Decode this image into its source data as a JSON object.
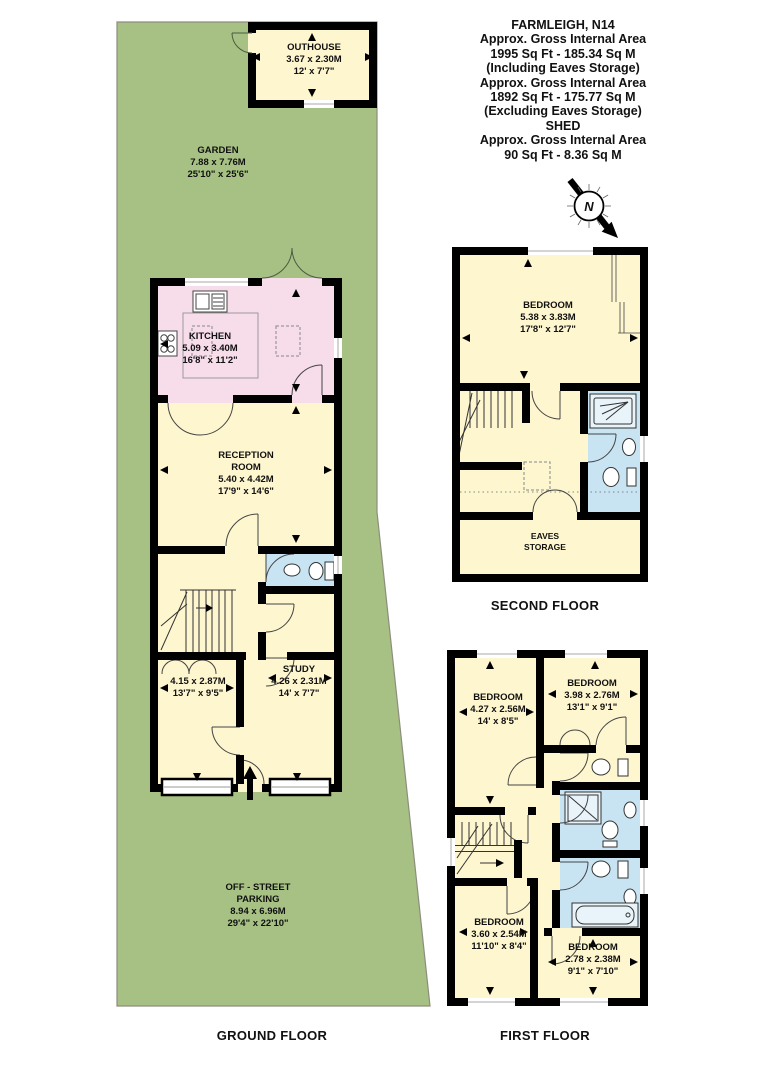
{
  "header": {
    "lines": [
      "FARMLEIGH, N14",
      "Approx. Gross Internal Area",
      "1995 Sq Ft - 185.34 Sq M",
      "(Including Eaves Storage)",
      "Approx. Gross Internal Area",
      "1892 Sq Ft - 175.77 Sq M",
      "(Excluding Eaves Storage)",
      "SHED",
      "Approx. Gross Internal Area",
      "90 Sq Ft - 8.36 Sq M"
    ]
  },
  "compass": {
    "north_label": "N"
  },
  "floors": {
    "ground": "GROUND FLOOR",
    "first": "FIRST FLOOR",
    "second": "SECOND FLOOR"
  },
  "rooms": {
    "outhouse": {
      "name": "OUTHOUSE",
      "metric": "3.67 x 2.30M",
      "imperial": "12' x 7'7\""
    },
    "garden": {
      "name": "GARDEN",
      "metric": "7.88 x 7.76M",
      "imperial": "25'10\" x 25'6\""
    },
    "kitchen": {
      "name": "KITCHEN",
      "metric": "5.09 x 3.40M",
      "imperial": "16'8\" x 11'2\""
    },
    "reception": {
      "name_line1": "RECEPTION",
      "name_line2": "ROOM",
      "metric": "5.40 x 4.42M",
      "imperial": "17'9\" x 14'6\""
    },
    "front_room": {
      "metric": "4.15 x 2.87M",
      "imperial": "13'7\" x 9'5\""
    },
    "study": {
      "name": "STUDY",
      "metric": "4.26 x 2.31M",
      "imperial": "14' x 7'7\""
    },
    "parking": {
      "name_line1": "OFF - STREET",
      "name_line2": "PARKING",
      "metric": "8.94 x 6.96M",
      "imperial": "29'4\" x 22'10\""
    },
    "second_bedroom": {
      "name": "BEDROOM",
      "metric": "5.38 x 3.83M",
      "imperial": "17'8\" x 12'7\""
    },
    "eaves_storage": {
      "name_line1": "EAVES",
      "name_line2": "STORAGE"
    },
    "first_bedroom_front_left": {
      "name": "BEDROOM",
      "metric": "4.27 x 2.56M",
      "imperial": "14' x 8'5\""
    },
    "first_bedroom_front_right": {
      "name": "BEDROOM",
      "metric": "3.98 x 2.76M",
      "imperial": "13'1\" x 9'1\""
    },
    "first_bedroom_back_left": {
      "name": "BEDROOM",
      "metric": "3.60 x 2.54M",
      "imperial": "11'10\" x 8'4\""
    },
    "first_bedroom_back_right": {
      "name": "BEDROOM",
      "metric": "2.78 x 2.38M",
      "imperial": "9'1\" x 7'10\""
    }
  },
  "colors": {
    "garden_green": "#a6c183",
    "room_cream": "#fdf6cf",
    "kitchen_pink": "#f7dcea",
    "bathroom_blue": "#c8e4f2",
    "wall_black": "#000000",
    "background": "#ffffff"
  }
}
